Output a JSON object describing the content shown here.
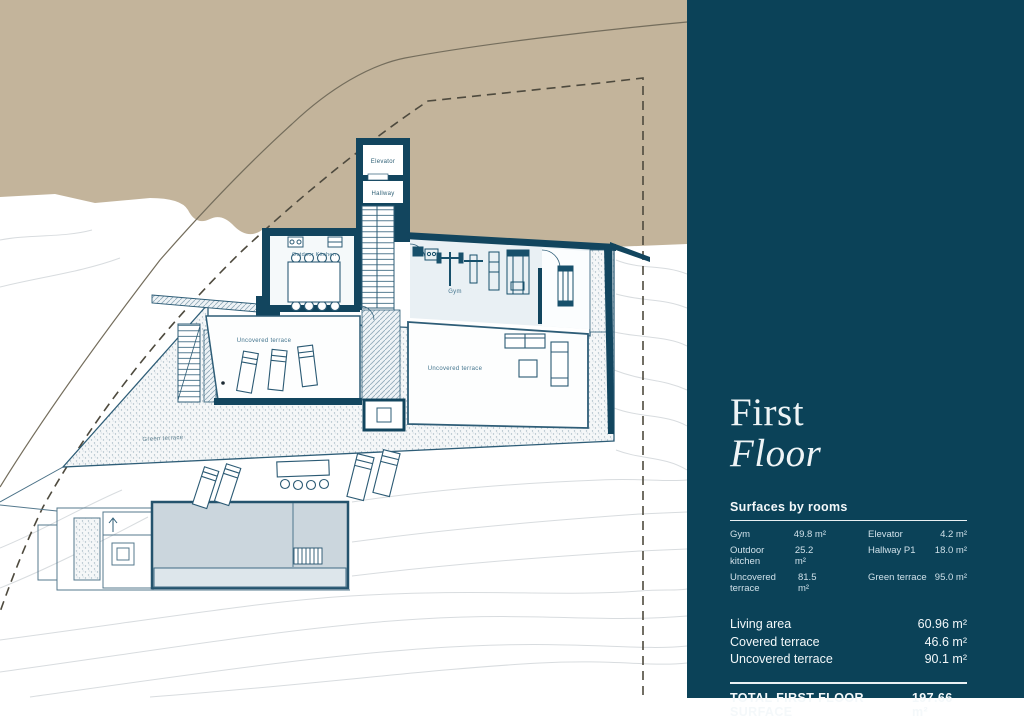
{
  "sidebar": {
    "title_line1": "First",
    "title_line2": "Floor",
    "section_heading": "Surfaces by rooms",
    "rooms_left": [
      {
        "label": "Gym",
        "value": "49.8 m²"
      },
      {
        "label": "Outdoor kitchen",
        "value": "25.2 m²"
      },
      {
        "label": "Uncovered terrace",
        "value": "81.5 m²"
      }
    ],
    "rooms_right": [
      {
        "label": "Elevator",
        "value": "4.2 m²"
      },
      {
        "label": "Hallway P1",
        "value": "18.0 m²"
      },
      {
        "label": "Green terrace",
        "value": "95.0 m²"
      }
    ],
    "summary": [
      {
        "label": "Living area",
        "value": "60.96 m²"
      },
      {
        "label": "Covered terrace",
        "value": "46.6 m²"
      },
      {
        "label": "Uncovered terrace",
        "value": "90.1 m²"
      }
    ],
    "total": {
      "label": "TOTAL FIRST FLOOR SURFACE",
      "value": "197.66 m²"
    }
  },
  "plan": {
    "labels": {
      "elevator": "Elevator",
      "hallway": "Hallway",
      "outdoor_kitchen": "Outdoor Kitchen",
      "gym": "Gym",
      "uncovered_terrace_left": "Uncovered terrace",
      "uncovered_terrace_right": "Uncovered terrace",
      "green_terrace": "Green terrace"
    }
  },
  "colors": {
    "sidebar_bg": "#0b4258",
    "terrain_tan": "#c3b49b",
    "wall_teal": "#12455e",
    "pool_blue": "#cbd6dd"
  }
}
